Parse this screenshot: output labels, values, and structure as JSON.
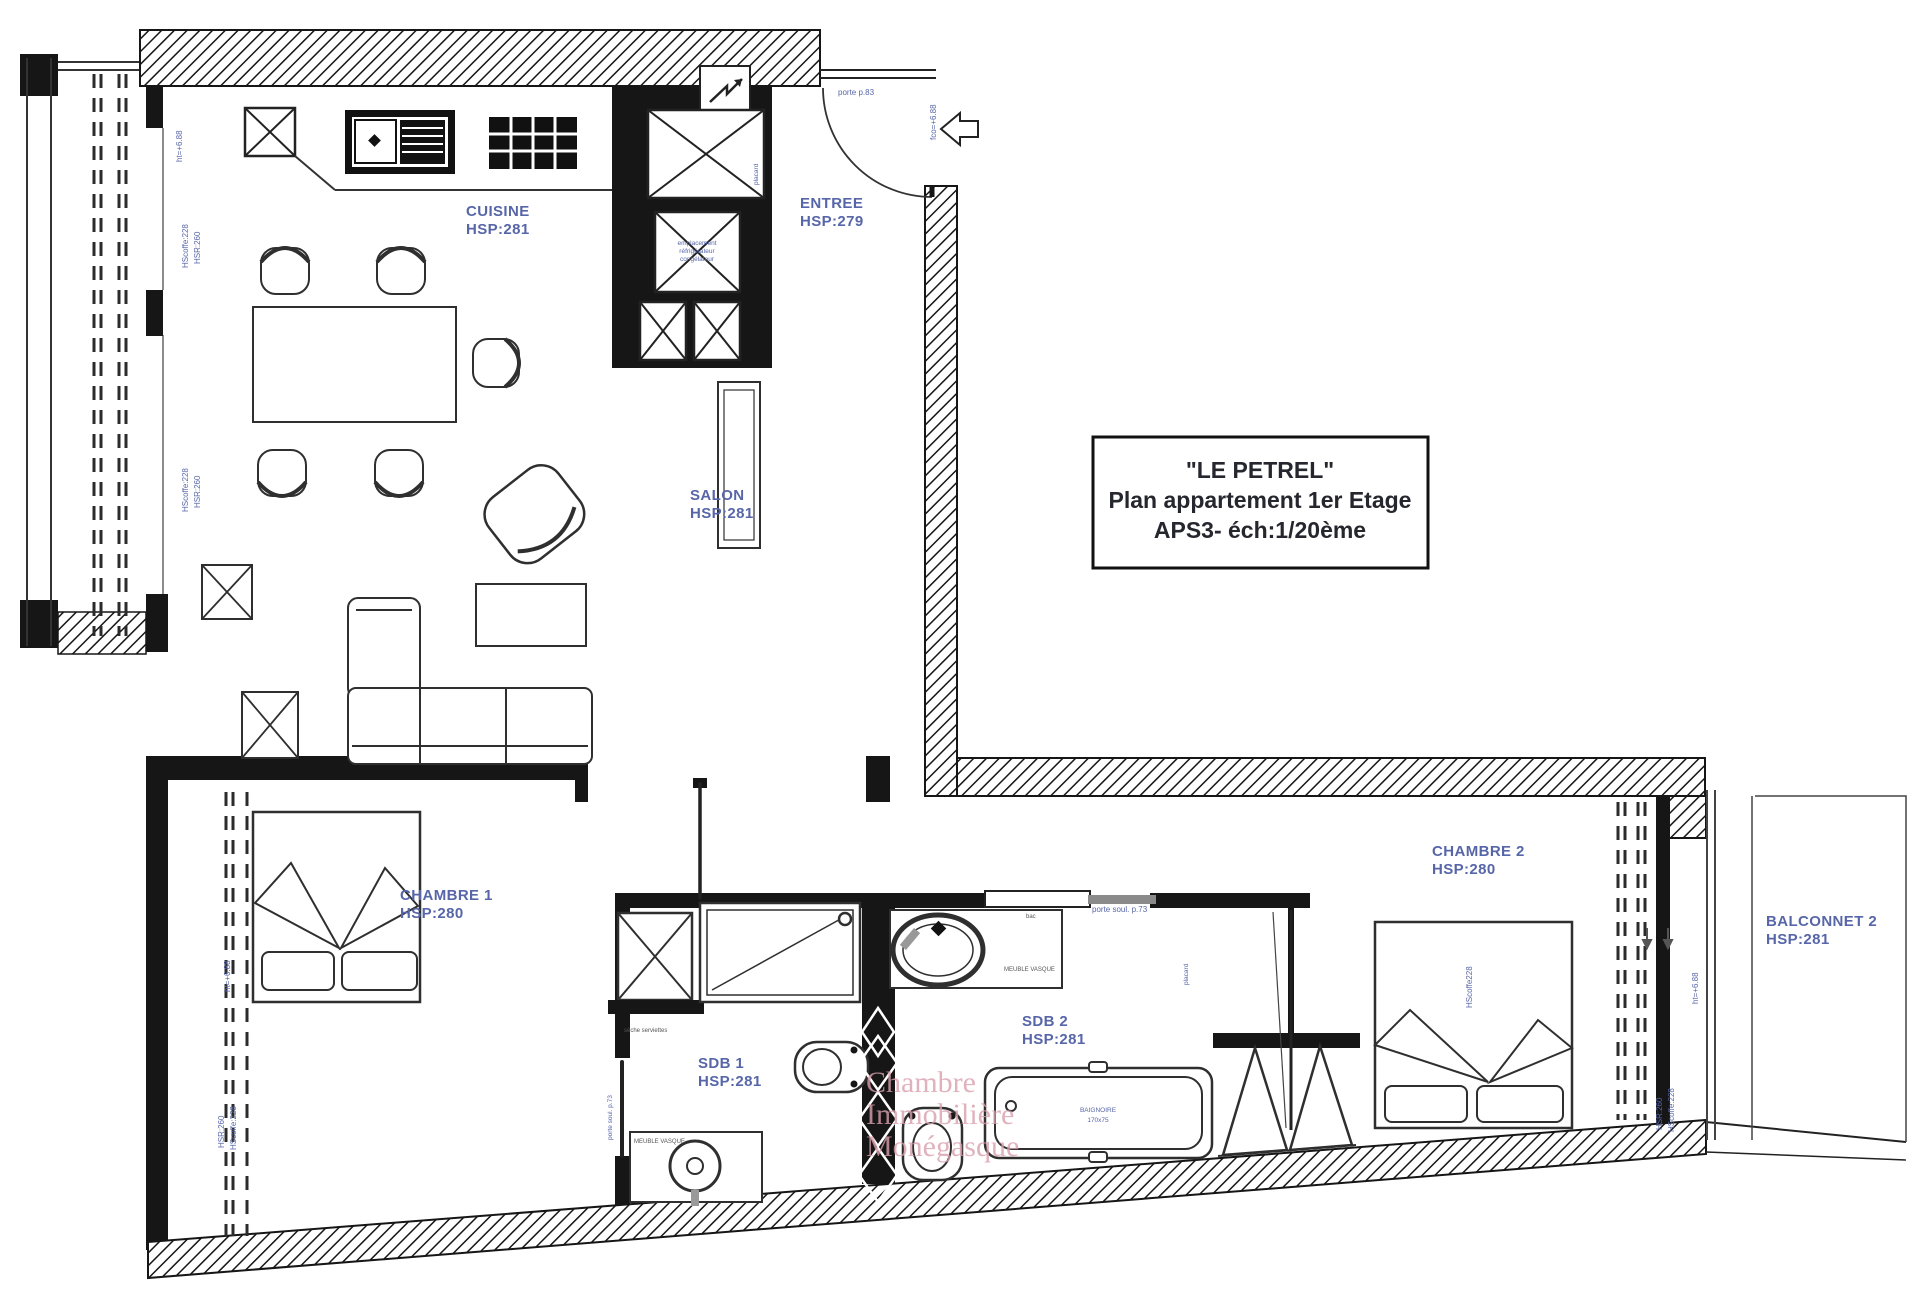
{
  "title_block": {
    "line1": "\"LE PETREL\"",
    "line2": "Plan appartement 1er Etage",
    "line3": "APS3- éch:1/20ème"
  },
  "rooms": {
    "cuisine": {
      "name": "CUISINE",
      "hsp": "HSP:281"
    },
    "entree": {
      "name": "ENTREE",
      "hsp": "HSP:279"
    },
    "salon": {
      "name": "SALON",
      "hsp": "HSP:281"
    },
    "chambre1": {
      "name": "CHAMBRE 1",
      "hsp": "HSP:280"
    },
    "sdb1": {
      "name": "SDB 1",
      "hsp": "HSP:281"
    },
    "sdb2": {
      "name": "SDB 2",
      "hsp": "HSP:281"
    },
    "chambre2": {
      "name": "CHAMBRE 2",
      "hsp": "HSP:280"
    },
    "balconnet2": {
      "name": "BALCONNET 2",
      "hsp": "HSP:281"
    }
  },
  "annotations": {
    "porte_entree": "porte p.83",
    "porte_soul": "porte soul. p.73",
    "fco": "fco=+6.88",
    "ht": "ht=+6.88",
    "hscoffe": "HScoffe:228",
    "hsr": "HSR:260",
    "hscoffe_bed": "HScoffe228",
    "placard": "placard",
    "fridge_line1": "emplacement",
    "fridge_line2": "réfrigérateur",
    "fridge_line3": "congélateur",
    "meuble_vasque": "MEUBLE VASQUE",
    "baignoire_line1": "BAIGNOIRE",
    "baignoire_line2": "170x75",
    "seche": "sèche serviettes",
    "bac": "bac"
  },
  "watermark": {
    "line1": "Chambre",
    "line2": "Immobilière",
    "line3": "Monégasque"
  },
  "colors": {
    "wall": "#161616",
    "label_blue": "#5766a8",
    "watermark_pink": "#d9a0ae"
  }
}
